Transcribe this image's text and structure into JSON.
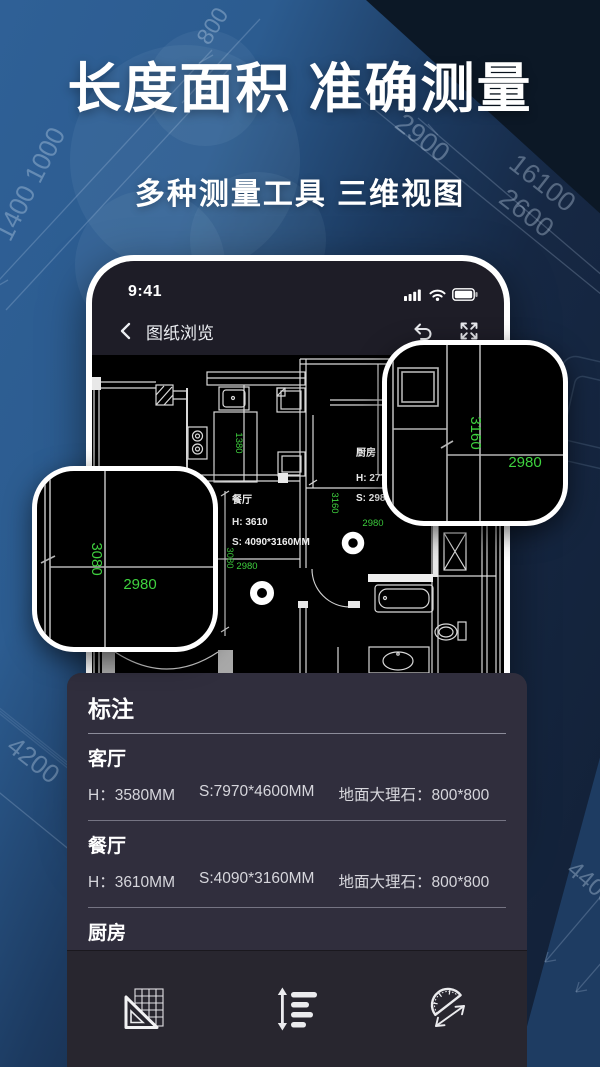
{
  "hero": {
    "title": "长度面积 准确测量",
    "subtitle": "多种测量工具 三维视图"
  },
  "background": {
    "dims": {
      "d1": "1400 1000",
      "d2": "800",
      "d3": "2900",
      "d4": "16100",
      "d5": "2600",
      "d6": "4200",
      "d7": "4400"
    }
  },
  "phone": {
    "status_bar": {
      "time": "9:41",
      "icons": [
        "signal-bars",
        "wifi",
        "battery"
      ]
    },
    "header": {
      "title": "图纸浏览",
      "icons": [
        "back-chevron",
        "undo",
        "fullscreen"
      ]
    },
    "plan": {
      "rooms": {
        "dining": {
          "name": "餐厅",
          "height": "H: 3610",
          "size": "S: 4090*3160MM"
        },
        "kitchen": {
          "name": "厨房",
          "height": "H: 2770",
          "size": "S: 2980*3160MM"
        }
      },
      "dims": {
        "kitchen_w": "1380",
        "corridor_h": "3160",
        "corridor_w": "2980",
        "dining_h": "3080",
        "dining_w": "2980"
      }
    },
    "magnifiers": {
      "left": {
        "v_dim": "3080",
        "h_dim": "2980"
      },
      "right": {
        "v_dim": "3160",
        "h_dim": "2980"
      }
    }
  },
  "annotation_panel": {
    "title": "标注",
    "rows": [
      {
        "room": "客厅",
        "height": "H：3580MM",
        "size": "S:7970*4600MM",
        "floor": "地面大理石：800*800"
      },
      {
        "room": "餐厅",
        "height": "H：3610MM",
        "size": "S:4090*3160MM",
        "floor": "地面大理石：800*800"
      },
      {
        "room": "厨房",
        "height": "H：2770MM",
        "size": "S:2980*3160MM",
        "floor": "地面地砖：600*600"
      }
    ],
    "toolbar_icons": [
      "set-square",
      "line-spacing",
      "protractor"
    ]
  },
  "colors": {
    "dim_green": "#3fd23f",
    "accent_light_blue": "#2e5f94",
    "panel_bg": "#302e3d",
    "plan_bg": "#000000"
  }
}
